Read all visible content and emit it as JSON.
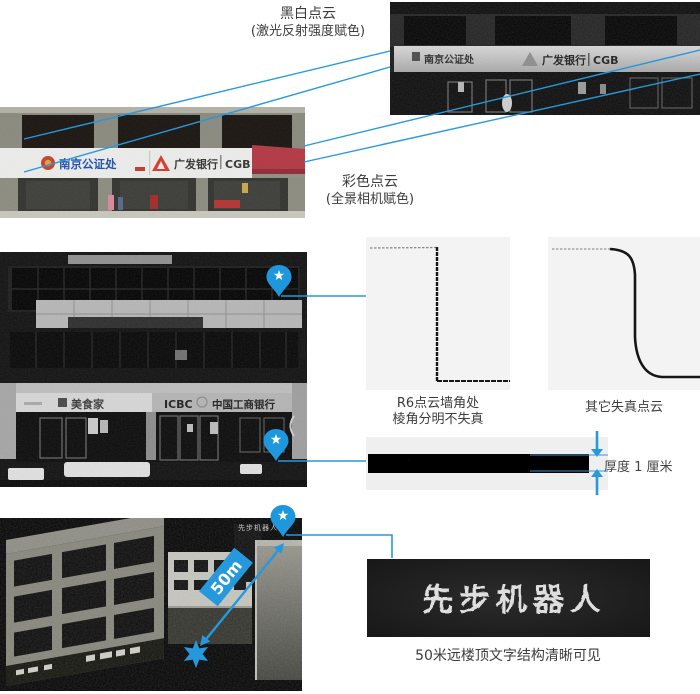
{
  "colors": {
    "accent": "#2699dc",
    "panel_bg": "#f3f3f3"
  },
  "top": {
    "bw_label": {
      "line1": "黑白点云",
      "line2": "(激光反射强度赋色)"
    },
    "color_label": {
      "line1": "彩色点云",
      "line2": "(全景相机赋色)"
    },
    "bw_image": {
      "sign_left": "南京公证处",
      "sign_right_name": "广发银行",
      "sign_right_abbr": "CGB"
    },
    "color_image": {
      "sign_left": "南京公证处",
      "sign_right_name": "广发银行",
      "sign_right_abbr": "CGB"
    }
  },
  "middle": {
    "storefront": {
      "sign_left": "美食家",
      "bank_en": "ICBC",
      "bank_cn": "中国工商银行"
    },
    "panel_sharp": {
      "caption_line1": "R6点云墙角处",
      "caption_line2": "棱角分明不失真"
    },
    "panel_distorted": {
      "caption": "其它失真点云"
    },
    "thickness": {
      "label": "厚度 1 厘米"
    }
  },
  "bottom": {
    "distance_badge": "50m",
    "rooftop_text": "先步机器人",
    "detail_text": "先步机器人",
    "caption": "50米远楼顶文字结构清晰可见"
  }
}
